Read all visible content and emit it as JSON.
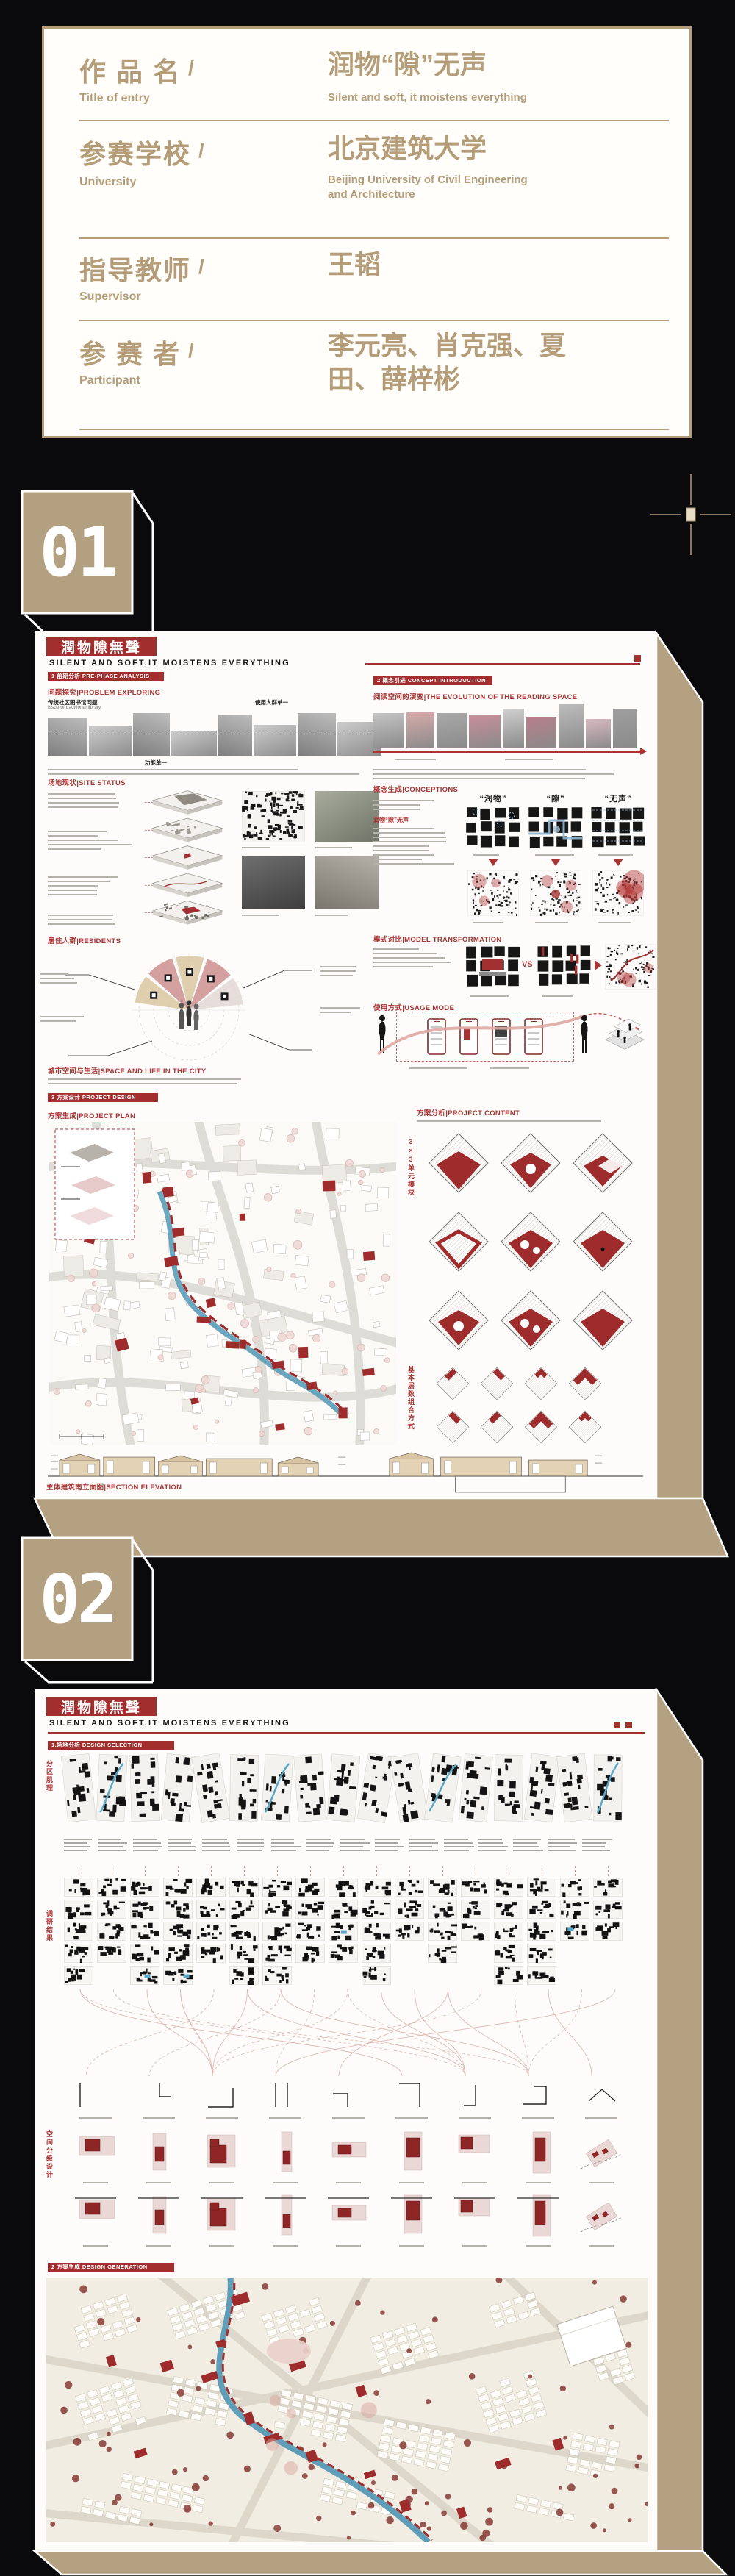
{
  "colors": {
    "background": "#0a0a0d",
    "tan": "#b49d78",
    "poster_tan": "#b4a181",
    "red": "#a32e2e",
    "dark_red": "#8e2626",
    "pink": "#d9a9a4",
    "blue": "#5d9fb9"
  },
  "info_card": {
    "slash": "/",
    "rows": [
      {
        "label_zh": "作 品 名",
        "label_en": "Title of entry",
        "value_zh": "润物“隙”无声",
        "value_en": "Silent and soft, it moistens everything"
      },
      {
        "label_zh": "参赛学校",
        "label_en": "University",
        "value_zh": "北京建筑大学",
        "value_en": "Beijing University of Civil Engineering and Architecture"
      },
      {
        "label_zh": "指导教师",
        "label_en": "Supervisor",
        "value_zh": "王韬",
        "value_en": ""
      },
      {
        "label_zh": "参 赛 者",
        "label_en": "Participant",
        "value_zh": "李元亮、肖克强、夏田、薛梓彬",
        "value_en": ""
      }
    ]
  },
  "badge1": "01",
  "badge2": "02",
  "poster1": {
    "title_zh": "潤物隙無聲",
    "subtitle": "SILENT AND SOFT,IT MOISTENS EVERYTHING",
    "section1": "1 前期分析 PRE-PHASE ANALYSIS",
    "section2": "2 概念引进 CONCEPT INTRODUCTION",
    "section3": "3 方案设计 PROJECT DESIGN",
    "sub_problem": "问题探究|PROBLEM EXPLORING",
    "sub_site": "场地现状|SITE STATUS",
    "sub_residents": "居住人群|RESIDENTS",
    "sub_city": "城市空间与生活|SPACE AND LIFE IN THE CITY",
    "sub_plan": "方案生成|PROJECT PLAN",
    "sub_analysis": "方案分析|PROJECT CONTENT",
    "sub_evolution": "阅读空间的演变|THE EVOLUTION OF THE READING SPACE",
    "sub_conceptions": "概念生成|CONCEPTIONS",
    "sub_model": "模式对比|MODEL TRANSFORMATION",
    "sub_usage": "使用方式|USAGE MODE",
    "caption_issue": "传统社区图书馆问题",
    "caption_issue_en": "Issue of traditional library",
    "caption_users": "使用人群单一",
    "caption_function": "功能单一",
    "red_phrase": "润物“隙”无声",
    "concept_labels": [
      "“润物”",
      "“隙”",
      "“无声”"
    ],
    "vs_label": "VS",
    "vertical_module": "3×3单元模块",
    "vertical_combo": "基本层数组合方式",
    "caption_elevation": "主体建筑南立面图|SECTION ELEVATION"
  },
  "poster2": {
    "title_zh": "潤物隙無聲",
    "subtitle": "SILENT AND SOFT,IT MOISTENS EVERYTHING",
    "section1": "1.场地分析 DESIGN SELECTION",
    "section2": "2 方案生成 DESIGN GENERATION",
    "vertical_zones": "分区肌理",
    "vertical_research": "调研结果",
    "vertical_grading": "空间分级设计"
  }
}
